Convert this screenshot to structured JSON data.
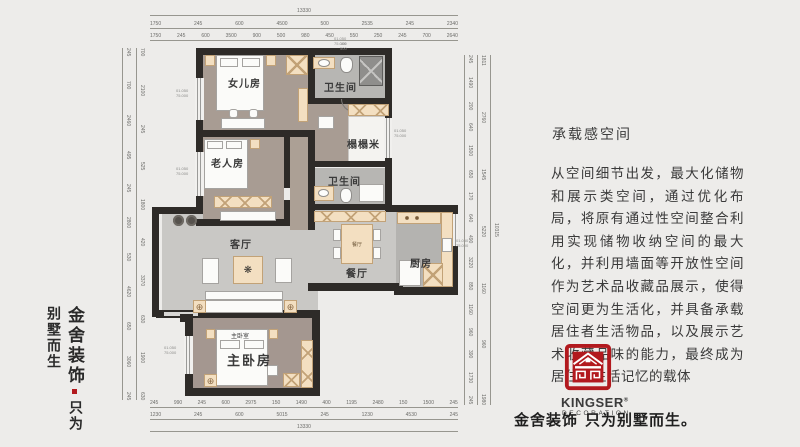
{
  "brand_left": {
    "line1": "金舍装饰",
    "line2": "只为别墅而生"
  },
  "article": {
    "title": "承载感空间",
    "body": "从空间细节出发，最大化储物和展示类空间，通过优化布局，将原有通过性空间整合利用实现储物收纳空间的最大化，并利用墙面等开放性空间作为艺术品收藏品展示，使得空间更为生活化，并具备承载居住者生活物品，以及展示艺术收藏品味的能力，最终成为居住者生活记忆的载体"
  },
  "logo": {
    "name": "KINGSER",
    "reg": "®",
    "sub": "DECORATION",
    "color": "#b2191e",
    "tagline_brand": "金舍装饰",
    "tagline_slogan": "只为别墅而生。"
  },
  "floorplan": {
    "labels": {
      "daughter": "女儿房",
      "bath1": "卫生间",
      "tatami": "榻榻米",
      "elder": "老人房",
      "bath2": "卫生间",
      "living": "客厅",
      "dining": "餐厅",
      "dining_table": "餐厅",
      "kitchen": "厨房",
      "master": "主卧房",
      "master_bed": "主卧室"
    },
    "level_marker": {
      "line1": "01.050",
      "line2": "75.000"
    },
    "dims": {
      "top1": [
        "13330"
      ],
      "top2": [
        "1750",
        "245",
        "600",
        "4500",
        "500",
        "2535",
        "245",
        "2340"
      ],
      "top3": [
        "1750",
        "245",
        "600",
        "3500",
        "900",
        "500",
        "980",
        "450",
        "550",
        "250",
        "245",
        "700",
        "2640"
      ],
      "top_extra": [
        "100",
        "500"
      ],
      "bottom1": [
        "245",
        "990",
        "245",
        "600",
        "2975",
        "150",
        "1490",
        "400",
        "1195",
        "2480",
        "150",
        "1500",
        "245"
      ],
      "bottom2": [
        "1230",
        "245",
        "600",
        "5015",
        "245",
        "1230",
        "4530",
        "245"
      ],
      "bottom3": [
        "13330"
      ],
      "left_outer": [
        "245",
        "700",
        "2460",
        "495",
        "245",
        "2800",
        "530",
        "4620",
        "650",
        "3060",
        "245"
      ],
      "left_inner": [
        "700",
        "2100",
        "245",
        "525",
        "1800",
        "420",
        "3370",
        "630",
        "1900",
        "630"
      ],
      "right_inner": [
        "245",
        "1490",
        "200",
        "640",
        "1500",
        "650",
        "170",
        "640",
        "490",
        "3220",
        "850",
        "1160",
        "960",
        "390",
        "1730",
        "245"
      ],
      "right_mid": [
        "1811",
        "2760",
        "1545",
        "5220",
        "1160",
        "960",
        "1980"
      ],
      "right_total": [
        "10315"
      ]
    }
  }
}
